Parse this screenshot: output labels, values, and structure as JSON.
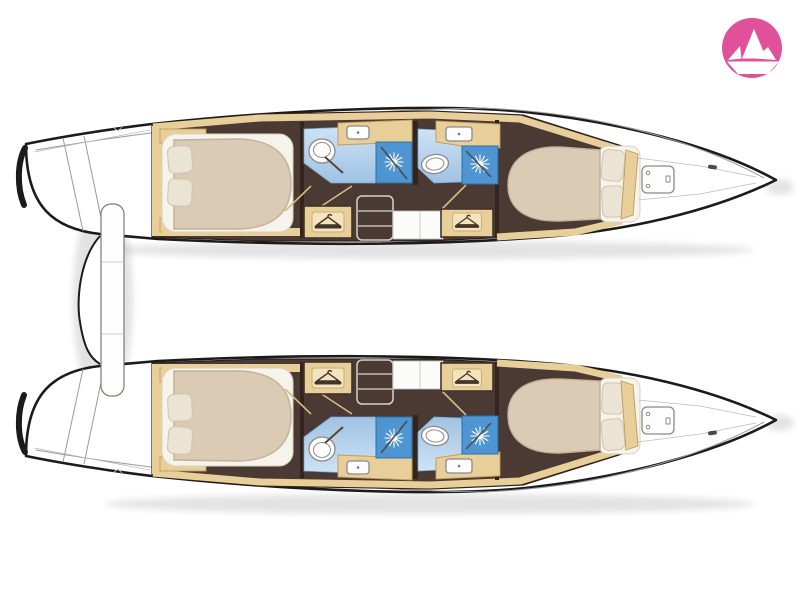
{
  "palette": {
    "outline": "#1b1b1b",
    "hull_white": "#ffffff",
    "line_gray": "#9a9a9a",
    "tan": "#e8cf9a",
    "tan_light": "#f3e4bd",
    "tan_border": "#bf9a5a",
    "wood_dark": "#43332a",
    "door_tan": "#d8b97f",
    "floor_brown": "#4a3a33",
    "floor_brown_dark": "#2e2018",
    "bed_duvet": "#dbcbb4",
    "bed_mattress": "#f6f3eb",
    "pillow": "#ebe4d4",
    "bath_floor_light": "#cfe3f4",
    "bath_floor": "#9fc2e4",
    "shower_blue": "#4e95d1",
    "logo_pink": "#e1519b",
    "logo_boat": "#ffffff"
  },
  "logo": {
    "icon": "paper-boat-icon",
    "background": "#e1519b",
    "foreground": "#ffffff"
  },
  "diagram": {
    "subject": "catamaran interior deck plan",
    "view": "top-down floor plan",
    "orientation": {
      "bow": "right",
      "stern": "left"
    },
    "hulls": [
      {
        "name": "port hull (top)",
        "rooms": [
          {
            "name": "aft double cabin",
            "fixtures": [
              "island double bed",
              "2 pillows",
              "side shelves",
              "wardrobe"
            ]
          },
          {
            "name": "aft bathroom",
            "fixtures": [
              "toilet",
              "sink counter",
              "separate shower"
            ]
          },
          {
            "name": "companionway",
            "fixtures": [
              "3-step stairs",
              "landing",
              "2 wardrobes"
            ]
          },
          {
            "name": "forward bathroom",
            "fixtures": [
              "toilet",
              "sink counter",
              "separate shower"
            ]
          },
          {
            "name": "forward double cabin",
            "fixtures": [
              "double bed",
              "2 pillows"
            ]
          },
          {
            "name": "forepeak",
            "fixtures": [
              "deck hatch"
            ]
          }
        ]
      },
      {
        "name": "starboard hull (bottom)",
        "rooms": [
          {
            "name": "aft double cabin",
            "fixtures": [
              "island double bed",
              "2 pillows",
              "side shelves",
              "wardrobe"
            ]
          },
          {
            "name": "aft bathroom",
            "fixtures": [
              "toilet",
              "sink counter",
              "separate shower"
            ]
          },
          {
            "name": "companionway",
            "fixtures": [
              "3-step stairs",
              "landing",
              "2 wardrobes"
            ]
          },
          {
            "name": "forward bathroom",
            "fixtures": [
              "toilet",
              "sink counter",
              "separate shower"
            ]
          },
          {
            "name": "forward double cabin",
            "fixtures": [
              "double bed",
              "2 pillows"
            ]
          },
          {
            "name": "forepeak",
            "fixtures": [
              "deck hatch"
            ]
          }
        ]
      }
    ],
    "stern_structures": [
      "transom steps",
      "aft platform arch",
      "cockpit bench"
    ],
    "counts": {
      "cabins": 4,
      "bathrooms": 4,
      "showers": 4,
      "toilets": 4,
      "wardrobes": 4,
      "bow_hatches": 2
    }
  }
}
